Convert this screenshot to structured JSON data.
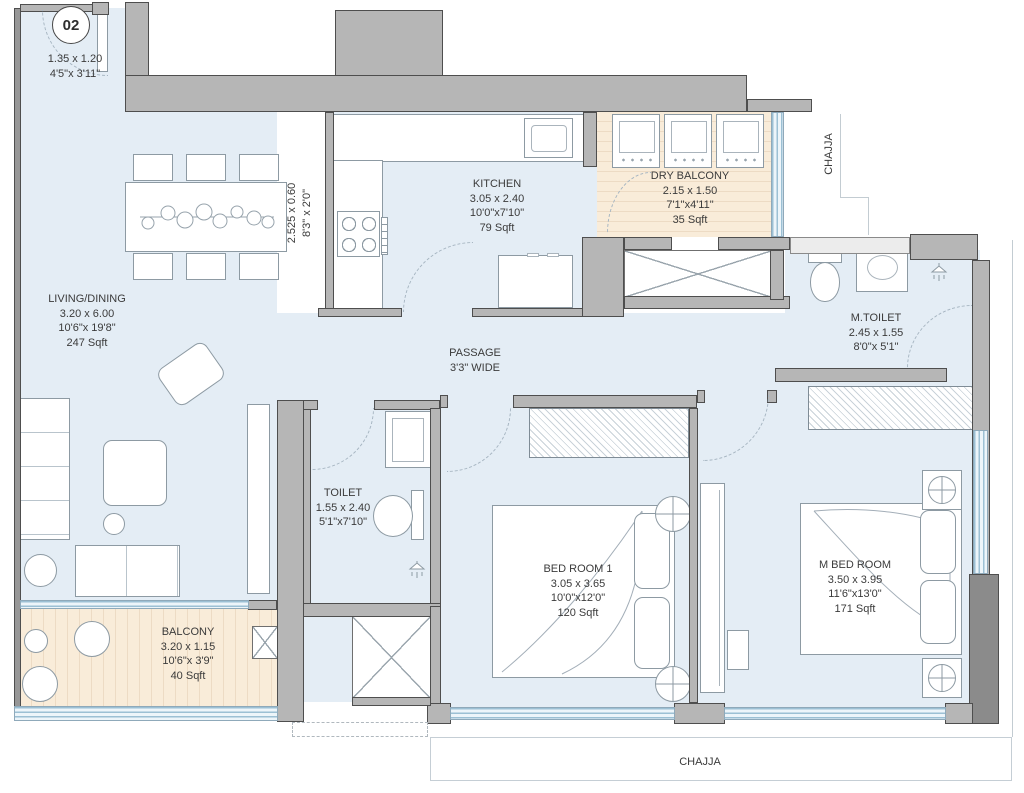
{
  "unit": {
    "number": "02",
    "entry_dim_m": "1.35 x 1.20",
    "entry_dim_ft": "4'5\"x 3'11\""
  },
  "rooms": {
    "living": {
      "name": "LIVING/DINING",
      "m": "3.20 x 6.00",
      "ft": "10'6\"x 19'8\"",
      "sqft": "247 Sqft"
    },
    "kitchen": {
      "name": "KITCHEN",
      "m": "3.05 x 2.40",
      "ft": "10'0\"x7'10\"",
      "sqft": "79 Sqft"
    },
    "dry_balcony": {
      "name": "DRY BALCONY",
      "m": "2.15 x 1.50",
      "ft": "7'1\"x4'11\"",
      "sqft": "35 Sqft"
    },
    "mtoilet": {
      "name": "M.TOILET",
      "m": "2.45 x 1.55",
      "ft": "8'0\"x 5'1\""
    },
    "passage": {
      "name": "PASSAGE",
      "width": "3'3\" WIDE"
    },
    "toilet": {
      "name": "TOILET",
      "m": "1.55 x 2.40",
      "ft": "5'1\"x7'10\""
    },
    "bedroom1": {
      "name": "BED ROOM 1",
      "m": "3.05 x 3.65",
      "ft": "10'0\"x12'0\"",
      "sqft": "120 Sqft"
    },
    "mbedroom": {
      "name": "M BED ROOM",
      "m": "3.50 x 3.95",
      "ft": "11'6\"x13'0\"",
      "sqft": "171 Sqft"
    },
    "balcony": {
      "name": "BALCONY",
      "m": "3.20 x 1.15",
      "ft": "10'6\"x 3'9\"",
      "sqft": "40 Sqft"
    },
    "platform": {
      "m": "2.525 x 0.60",
      "ft": "8'3\" x 2'0\""
    }
  },
  "chajja": {
    "right": "CHAJJA",
    "bottom": "CHAJJA"
  },
  "colors": {
    "floor": "#e4edf5",
    "balcony_floor": "#f9ecd9",
    "wall": "#b6b6b6",
    "wall_edge": "#4e4e4e",
    "window": "#9cc0d4",
    "label_text": "#3b3b3b"
  }
}
